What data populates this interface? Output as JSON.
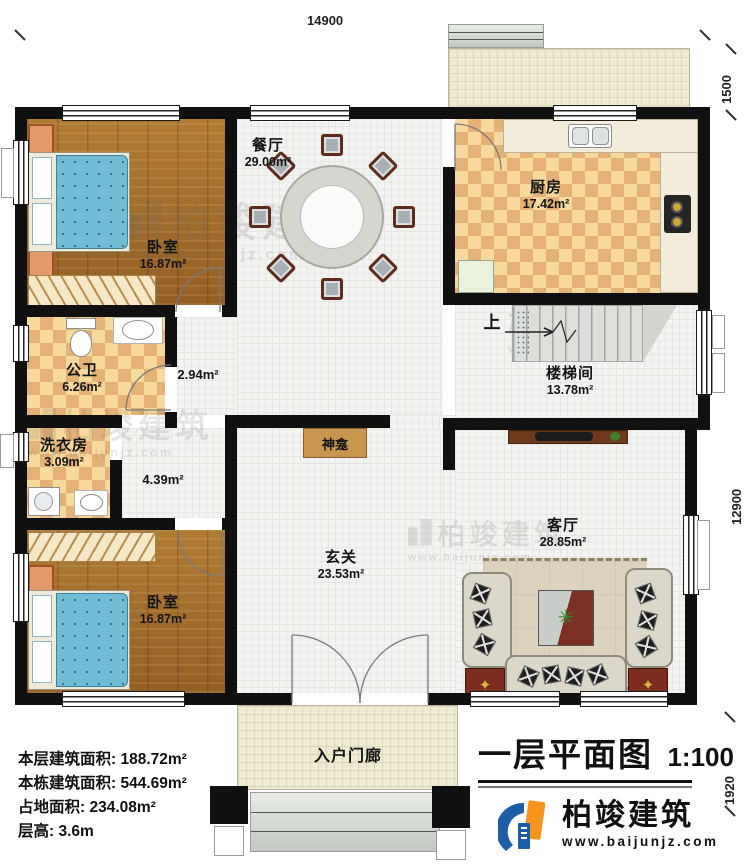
{
  "plan": {
    "title": "一层平面图",
    "scale": "1:100",
    "up_label": "上",
    "dims": {
      "top": "14900",
      "right_top": "1500",
      "right_middle": "12900",
      "right_bottom": "1920"
    },
    "rooms": {
      "bedroom1": {
        "name": "卧室",
        "area": "16.87m²"
      },
      "dining": {
        "name": "餐厅",
        "area": "29.00m²"
      },
      "kitchen": {
        "name": "厨房",
        "area": "17.42m²"
      },
      "bathroom": {
        "name": "公卫",
        "area": "6.26m²"
      },
      "hall": {
        "area": "2.94m²"
      },
      "laundry": {
        "name": "洗衣房",
        "area": "3.09m²"
      },
      "corridor": {
        "area": "4.39m²"
      },
      "stairwell": {
        "name": "楼梯间",
        "area": "13.78m²"
      },
      "shrine": {
        "name": "神龛"
      },
      "foyer": {
        "name": "玄关",
        "area": "23.53m²"
      },
      "living": {
        "name": "客厅",
        "area": "28.85m²"
      },
      "bedroom2": {
        "name": "卧室",
        "area": "16.87m²"
      },
      "porch": {
        "name": "入户门廊"
      }
    },
    "stats": [
      {
        "label": "本层建筑面积:",
        "value": "188.72m²"
      },
      {
        "label": "本栋建筑面积:",
        "value": "544.69m²"
      },
      {
        "label": "占地面积:",
        "value": "234.08m²"
      },
      {
        "label": "层高:",
        "value": "3.6m"
      }
    ],
    "brand": {
      "name": "柏竣建筑",
      "url": "www.baijunjz.com"
    },
    "colors": {
      "wall": "#101010",
      "logo_blue": "#1b5ea6",
      "logo_orange": "#f7941d"
    }
  }
}
